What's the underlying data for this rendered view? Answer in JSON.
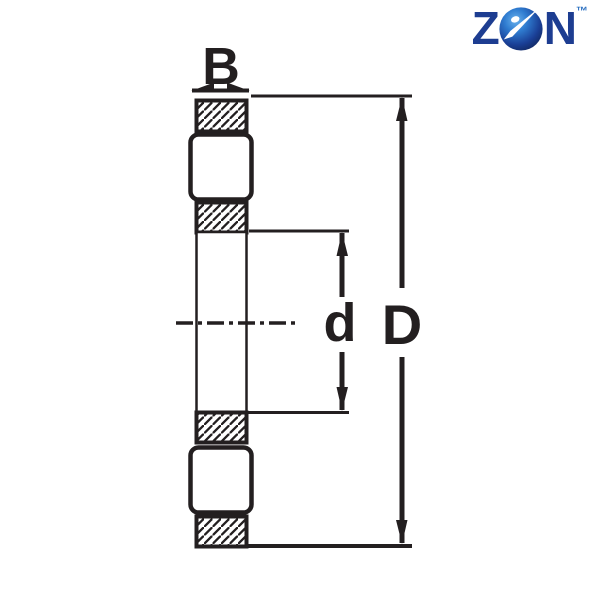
{
  "page": {
    "background_color": "#ffffff",
    "description": "Technical catalog drawing of a bearing cross-section with dimension labels"
  },
  "logo": {
    "letter_z": "Z",
    "letter_n": "N",
    "trademark": "™",
    "ball_icon": "bearing-ball-icon",
    "colors": {
      "letters_navy": "#1d3d91",
      "ball_light_blue": "#55a4e6",
      "ball_mid_blue": "#2f7cd0",
      "ball_dark_blue": "#122a66",
      "ball_dot_white": "#ffffff"
    }
  },
  "drawing": {
    "line_color": "#231f20",
    "fill_color": "#ffffff",
    "labels": {
      "width": "B",
      "bore_diameter": "d",
      "outer_diameter": "D"
    }
  }
}
